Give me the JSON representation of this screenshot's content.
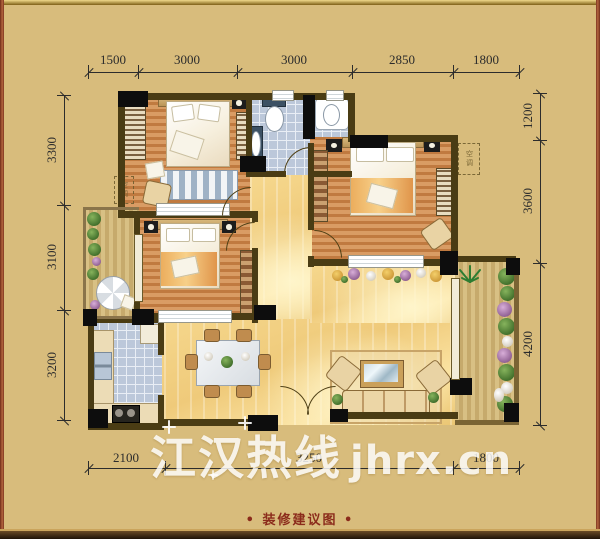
{
  "dimensions": {
    "top": [
      "1500",
      "3000",
      "3000",
      "2850",
      "1800"
    ],
    "left": [
      "3300",
      "3100",
      "3200"
    ],
    "right": [
      "1200",
      "3600",
      "4200"
    ],
    "bottom": [
      "2100",
      "3250",
      "1800"
    ]
  },
  "watermark": {
    "cn": "江汉热线",
    "en": "jhrx.cn"
  },
  "caption": {
    "bullet_left": "•",
    "text": "装修建议图",
    "bullet_right": "•"
  },
  "labels": {
    "air_conditioner": "空调"
  },
  "colors": {
    "background": "#d8bc7c",
    "wall": "#4a3c14",
    "column": "#0d0d0d",
    "bedroom_floor_a": "#c07a40",
    "bedroom_floor_b": "#d99c64",
    "tile": "#bcc8da",
    "tile_grout": "#e9eef5",
    "balcony_plank_a": "#d8c084",
    "balcony_plank_b": "#c6aa6c",
    "plant_green": "#4e7d33",
    "dim_line": "#2c2c2c",
    "watermark": "#ffffff",
    "caption": "#8b2b1b"
  }
}
